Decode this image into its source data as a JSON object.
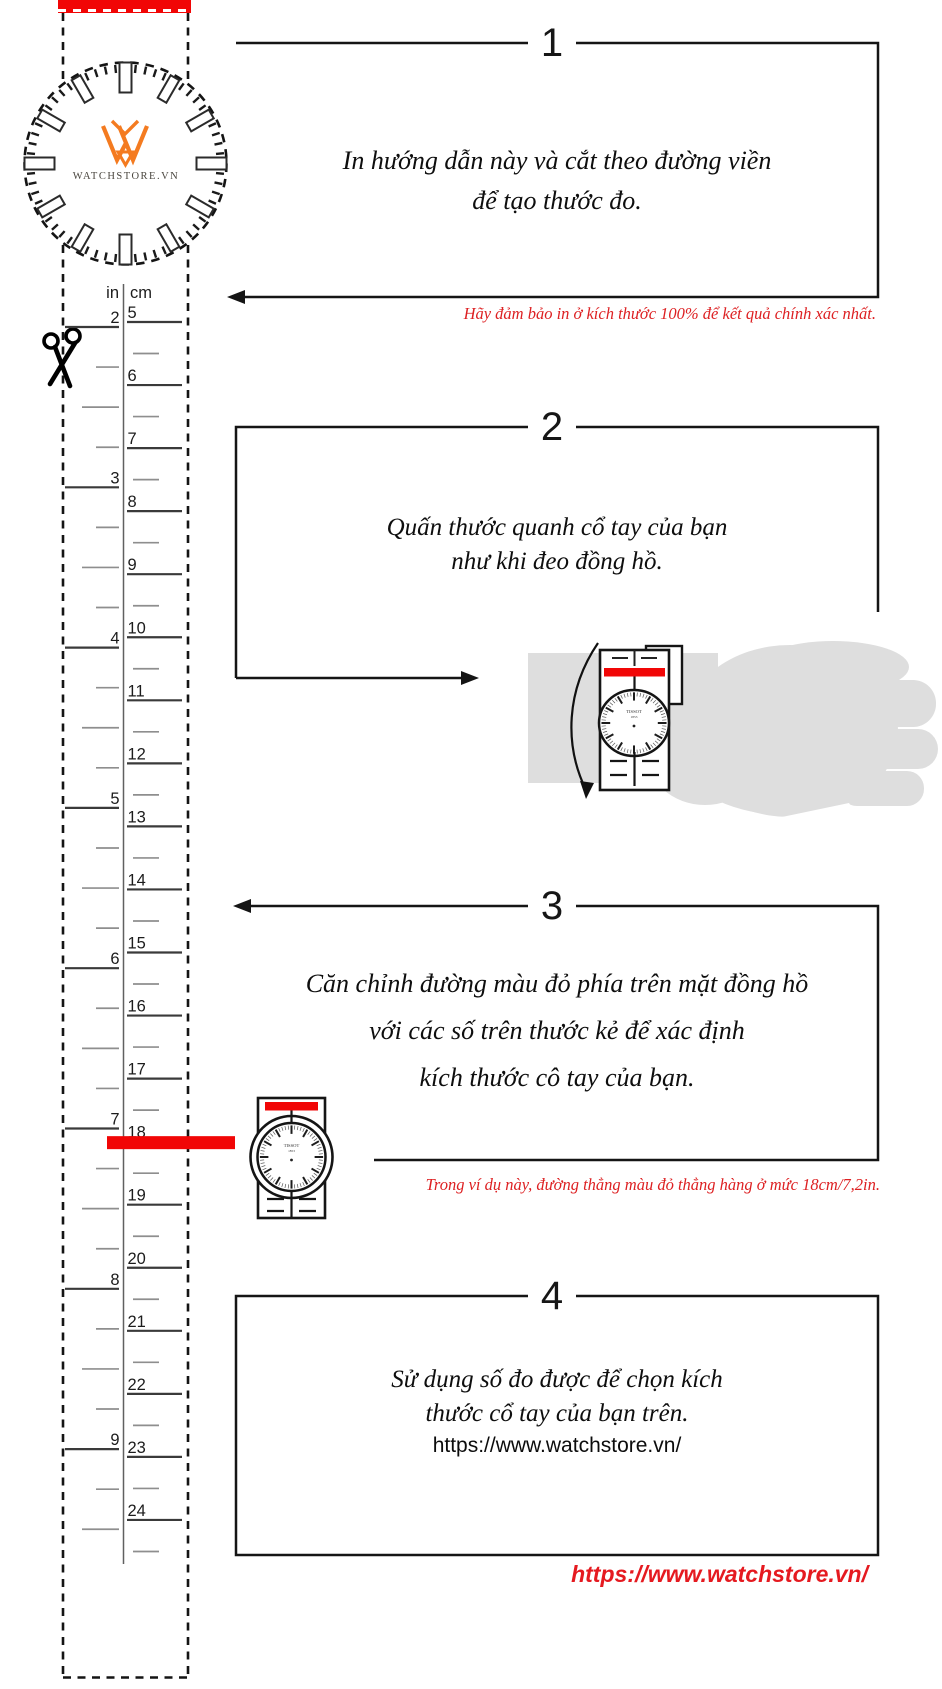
{
  "colors": {
    "red_bar": "#f10606",
    "red_text": "#dd2022",
    "hand_gray": "#dedede",
    "logo_orange": "#f47b20",
    "line_black": "#151515",
    "tick_dark": "#3a3a3a",
    "tick_light": "#8e8e8e"
  },
  "watch_face": {
    "brand": "WATCHSTORE.VN"
  },
  "ruler": {
    "left_unit": "in",
    "right_unit": "cm",
    "in_numbers": [
      2,
      3,
      4,
      5,
      6,
      7,
      8,
      9
    ],
    "cm_numbers": [
      5,
      6,
      7,
      8,
      9,
      10,
      11,
      12,
      13,
      14,
      15,
      16,
      17,
      18,
      19,
      20,
      21,
      22,
      23,
      24
    ],
    "red_line_cm": 18
  },
  "steps": [
    {
      "number": "1",
      "lines": [
        "In hướng dẫn này và cắt theo đường viền",
        "để tạo thước đo."
      ],
      "note": "Hãy đảm bảo in ở kích thước 100% để kết quả chính xác nhất."
    },
    {
      "number": "2",
      "lines": [
        "Quấn thước quanh cổ tay của bạn",
        "như khi đeo đồng hồ."
      ]
    },
    {
      "number": "3",
      "lines": [
        "Căn chỉnh đường màu đỏ phía trên mặt đồng hồ",
        "với các số trên thước kẻ để xác định",
        "kích thước cô tay của bạn."
      ],
      "note": "Trong ví dụ này, đường thẳng màu đỏ thẳng hàng ở mức 18cm/7,2in."
    },
    {
      "number": "4",
      "lines": [
        "Sử dụng số đo được để chọn kích",
        "thước cổ tay của bạn trên."
      ],
      "link": "https://www.watchstore.vn/"
    }
  ],
  "footer": {
    "url": "https://www.watchstore.vn/"
  },
  "wrist_illustration": {
    "dial_brand": "TISSOT",
    "dial_brand_year": "1853"
  }
}
